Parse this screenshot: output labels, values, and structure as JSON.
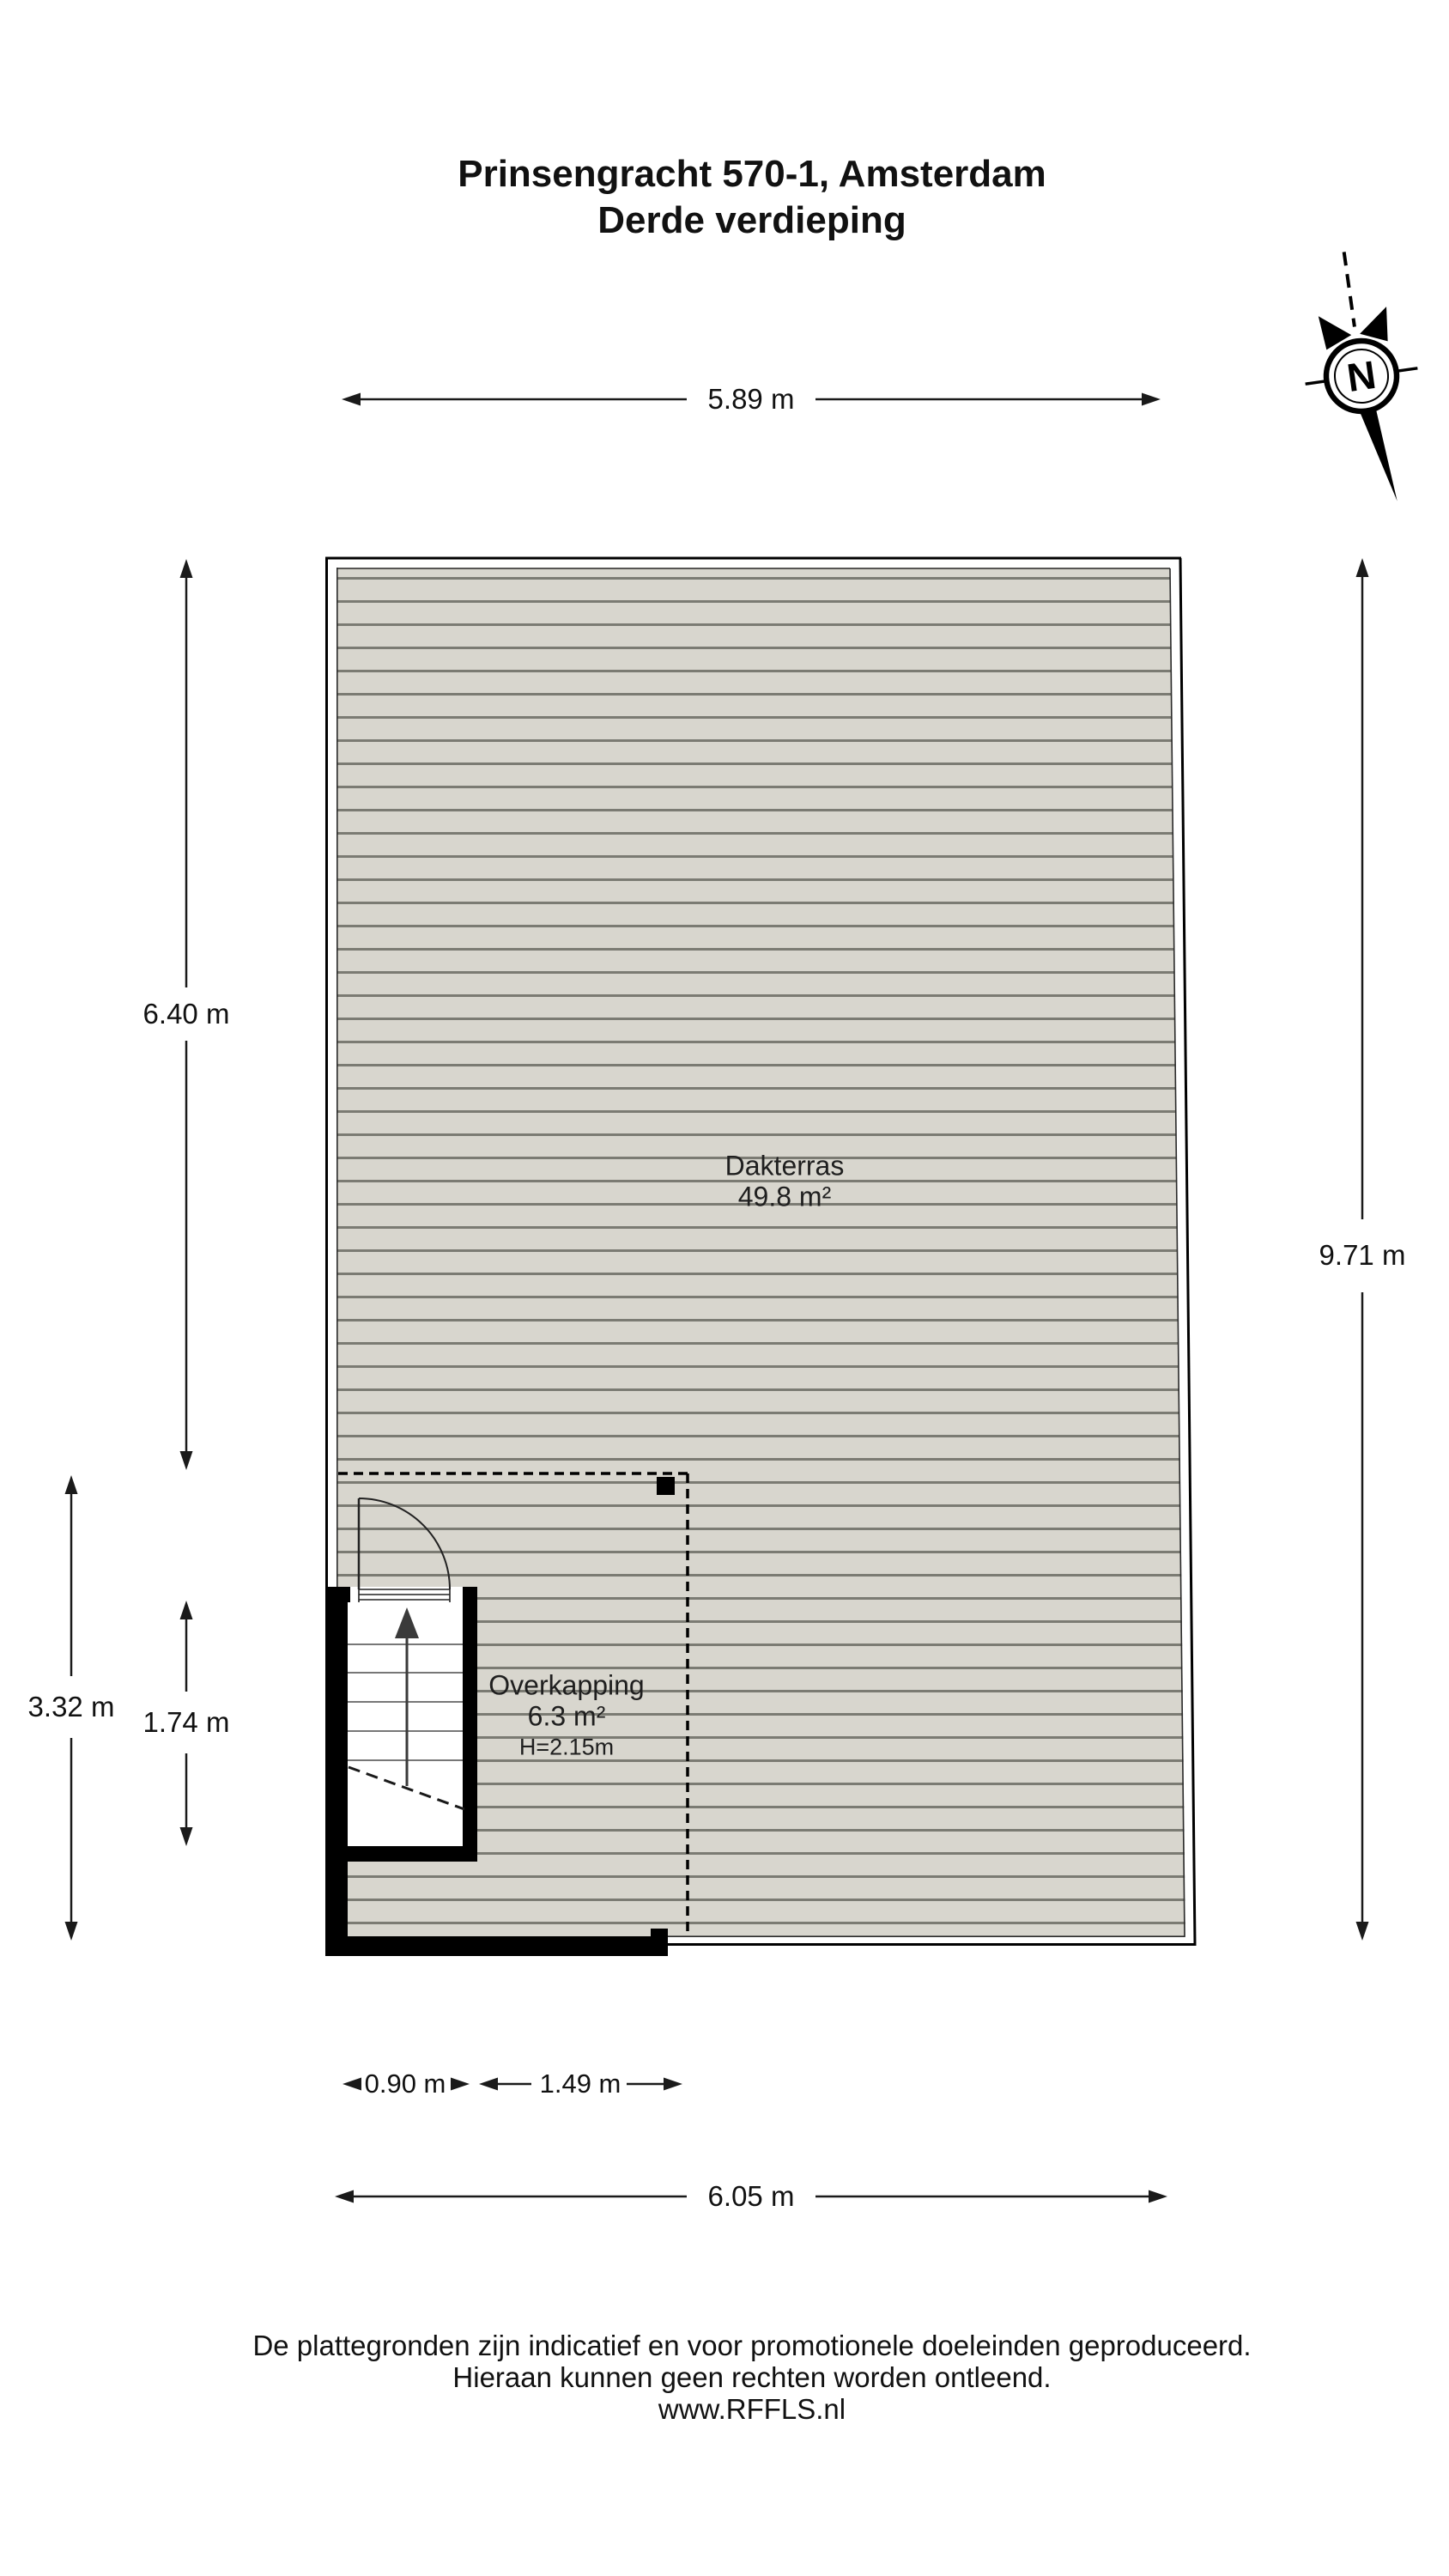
{
  "title": {
    "line1": "Prinsengracht 570-1, Amsterdam",
    "line2": "Derde verdieping"
  },
  "compass": {
    "label": "N"
  },
  "rooms": {
    "dakterras": {
      "name": "Dakterras",
      "area": "49.8 m²"
    },
    "overkapping": {
      "name": "Overkapping",
      "area": "6.3 m²",
      "height": "H=2.15m"
    }
  },
  "dimensions": {
    "top_width": "5.89 m",
    "left_upper": "6.40 m",
    "left_lower": "3.32 m",
    "stairwell_height": "1.74 m",
    "right_height": "9.71 m",
    "stairwell_width": "0.90 m",
    "overhang_width": "1.49 m",
    "bottom_width": "6.05 m"
  },
  "footer": {
    "line1": "De plattegronden zijn indicatief en voor promotionele doeleinden geproduceerd.",
    "line2": "Hieraan kunnen geen rechten worden ontleend.",
    "line3": "www.RFFLS.nl"
  },
  "colors": {
    "decking_fill": "#d8d6ce",
    "board_line": "#7b7b73",
    "wall": "#000000",
    "dimension": "#1a1a1a"
  }
}
